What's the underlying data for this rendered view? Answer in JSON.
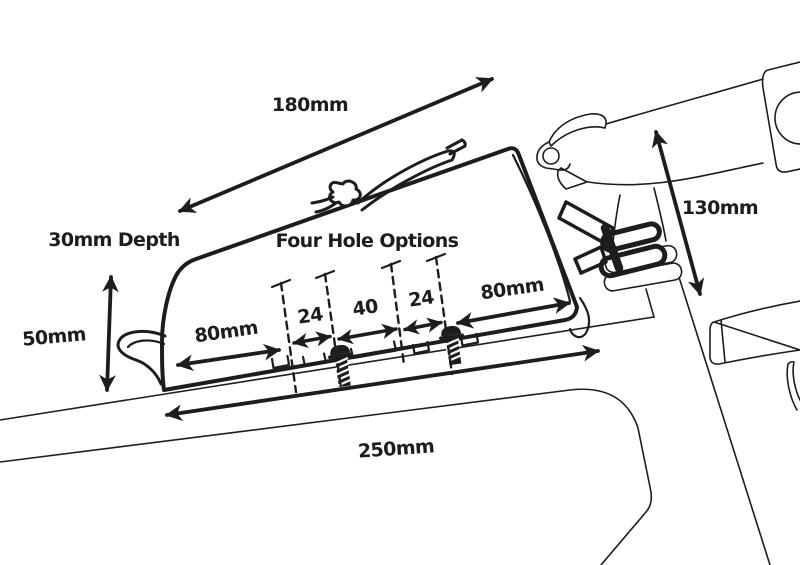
{
  "diagram": {
    "description_colors": {
      "ink": "#1d1d1b",
      "paper": "#ffffff"
    },
    "labels": {
      "top_length": "180mm",
      "depth": "30mm Depth",
      "front_height": "50mm",
      "hole_options_title": "Four Hole Options",
      "left_slot_length": "80mm",
      "hole_gap_left": "24",
      "hole_gap_middle": "40",
      "hole_gap_right": "24",
      "right_slot_length": "80mm",
      "base_length": "250mm",
      "head_height": "130mm"
    }
  }
}
